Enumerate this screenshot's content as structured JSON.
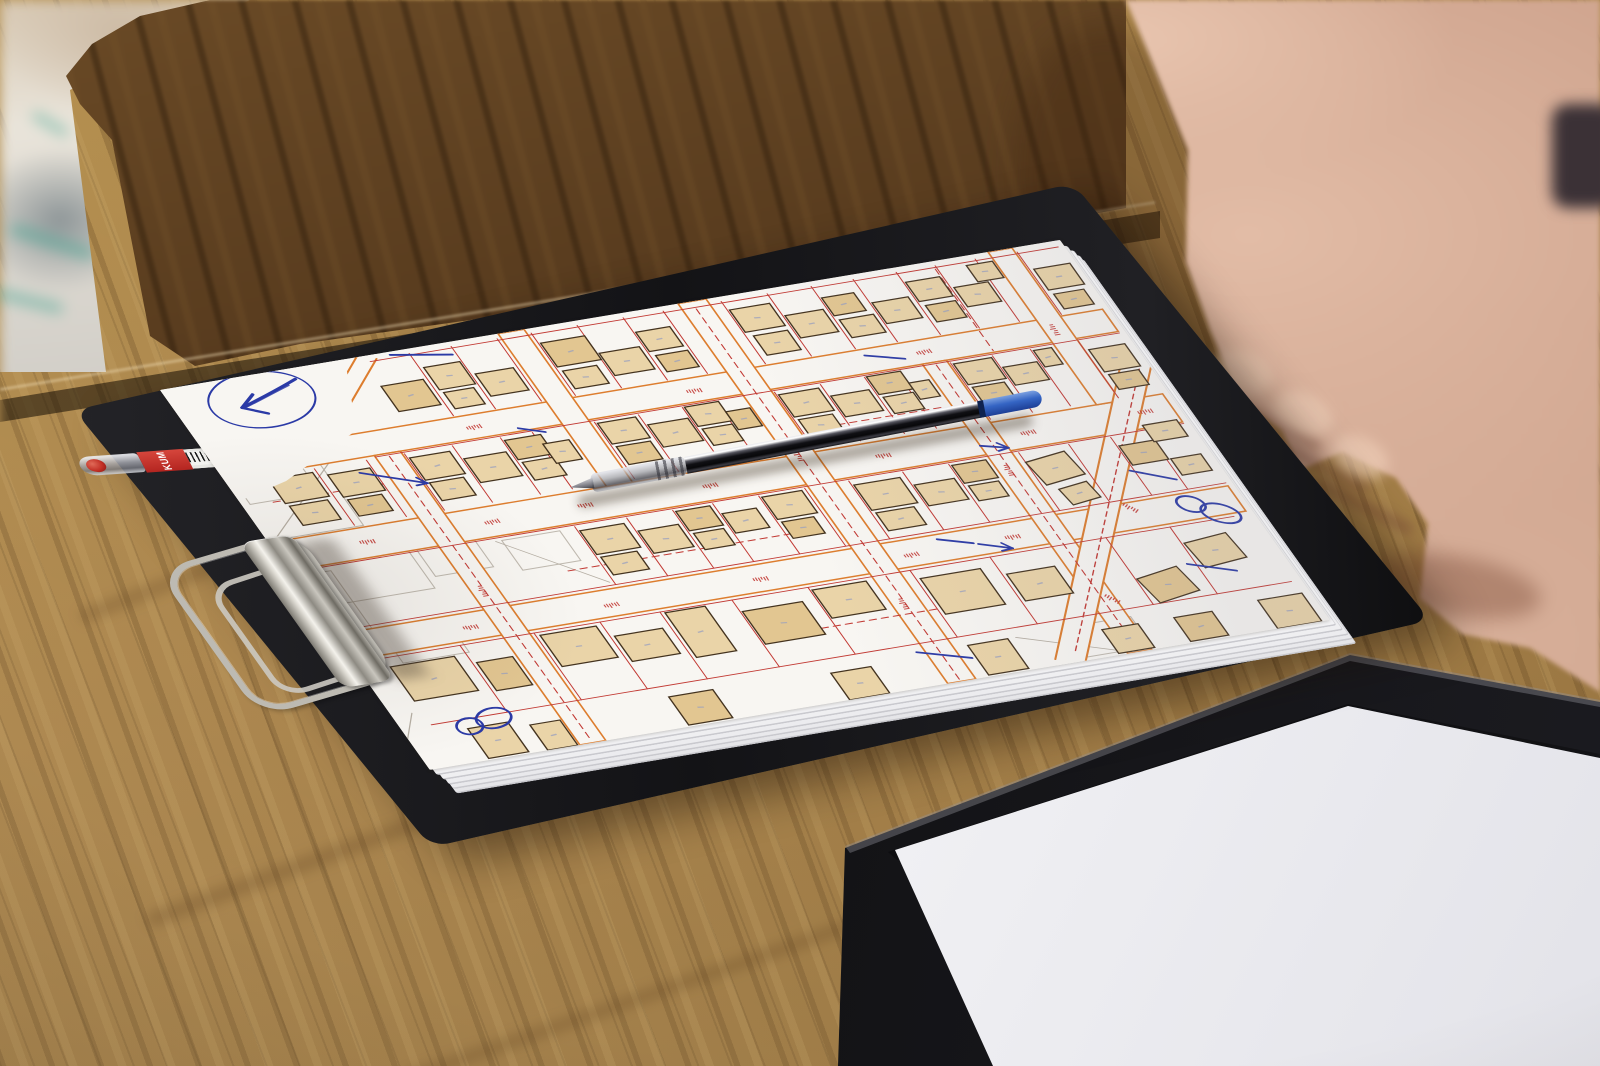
{
  "scene": {
    "description": "Photograph of a black clipboard on a light oak table holding a stack of printed cadastral city-map sheets annotated in blue pen; a transparent ballpoint pen with a blue cap lies across the map; a capped red pen is tucked under the clipboard; a metal clip holds the sheets; a person's hand rests on the table at top right; a second black folder with a blank white sheet sits at bottom right; a darker wooden table and blurred fabric appear in the background",
    "objects_present": [
      "oak table",
      "dark background table",
      "blurred fabric",
      "clipboard",
      "paper stack",
      "cadastral map",
      "metal clip",
      "red pen",
      "ballpoint pen",
      "hand",
      "black folder",
      "blank paper"
    ]
  },
  "colors": {
    "oak_table": "#ab854d",
    "dark_table": "#5a3d1f",
    "clipboard": "#17171a",
    "paper": "#f8f6f2",
    "building_fill": "#ead4a8",
    "building_stroke": "#44331f",
    "street_orange": "#dd7d2e",
    "parcel_red": "#c23a34",
    "pencil_gray": "#b5aea3",
    "ink_blue": "#2b3aa6",
    "pen_cap_blue": "#3565c4",
    "red_pen_body": "#3c1214",
    "skin": "#cfa48e"
  },
  "objects": {
    "red_pen": {
      "brand": "KUM",
      "has_barcode": true,
      "cap": "clear with red tip visible"
    },
    "ballpoint_pen": {
      "barrel": "translucent dark",
      "end_cap": "blue"
    },
    "clip": {
      "type": "flat metal clipboard clip with wire lever"
    },
    "annotations": {
      "style": "blue ballpoint handwriting: circled arrow, figure-eight loops, short strokes and small arrows"
    }
  },
  "map": {
    "buildings": [
      [
        200,
        40,
        42,
        34
      ],
      [
        250,
        26,
        36,
        30
      ],
      [
        252,
        60,
        30,
        22
      ],
      [
        292,
        44,
        38,
        30
      ],
      [
        370,
        20,
        44,
        32
      ],
      [
        372,
        58,
        34,
        24
      ],
      [
        416,
        44,
        40,
        30
      ],
      [
        462,
        26,
        34,
        26
      ],
      [
        465,
        58,
        32,
        22
      ],
      [
        560,
        18,
        40,
        30
      ],
      [
        565,
        54,
        34,
        26
      ],
      [
        606,
        36,
        38,
        30
      ],
      [
        650,
        22,
        32,
        24
      ],
      [
        652,
        52,
        34,
        24
      ],
      [
        692,
        38,
        36,
        28
      ],
      [
        735,
        20,
        34,
        26
      ],
      [
        738,
        52,
        30,
        22
      ],
      [
        775,
        36,
        34,
        26
      ],
      [
        800,
        12,
        26,
        22
      ],
      [
        858,
        30,
        36,
        28
      ],
      [
        860,
        64,
        30,
        20
      ],
      [
        40,
        130,
        44,
        32
      ],
      [
        42,
        166,
        38,
        26
      ],
      [
        96,
        136,
        42,
        30
      ],
      [
        98,
        170,
        34,
        22
      ],
      [
        180,
        132,
        40,
        30
      ],
      [
        182,
        166,
        34,
        24
      ],
      [
        228,
        144,
        42,
        32
      ],
      [
        276,
        130,
        36,
        26
      ],
      [
        278,
        160,
        32,
        24
      ],
      [
        308,
        142,
        26,
        26
      ],
      [
        370,
        128,
        38,
        28
      ],
      [
        372,
        160,
        34,
        24
      ],
      [
        414,
        140,
        40,
        30
      ],
      [
        458,
        126,
        34,
        26
      ],
      [
        460,
        156,
        30,
        22
      ],
      [
        492,
        140,
        24,
        24
      ],
      [
        550,
        130,
        40,
        30
      ],
      [
        552,
        164,
        34,
        22
      ],
      [
        596,
        142,
        38,
        28
      ],
      [
        640,
        126,
        34,
        24
      ],
      [
        642,
        154,
        30,
        22
      ],
      [
        674,
        142,
        20,
        22
      ],
      [
        726,
        128,
        38,
        28
      ],
      [
        728,
        160,
        32,
        22
      ],
      [
        768,
        142,
        34,
        24
      ],
      [
        806,
        128,
        18,
        22
      ],
      [
        856,
        138,
        36,
        30
      ],
      [
        858,
        172,
        30,
        20
      ],
      [
        286,
        254,
        44,
        32
      ],
      [
        288,
        290,
        36,
        24
      ],
      [
        338,
        266,
        40,
        30
      ],
      [
        384,
        250,
        34,
        26
      ],
      [
        386,
        280,
        30,
        22
      ],
      [
        424,
        262,
        34,
        26
      ],
      [
        470,
        250,
        40,
        30
      ],
      [
        472,
        284,
        32,
        22
      ],
      [
        560,
        254,
        46,
        34
      ],
      [
        562,
        292,
        38,
        24
      ],
      [
        614,
        266,
        40,
        28
      ],
      [
        660,
        250,
        34,
        24
      ],
      [
        662,
        278,
        30,
        20
      ],
      [
        730,
        258,
        42,
        32,
        -8
      ],
      [
        742,
        298,
        30,
        22,
        -8
      ],
      [
        822,
        260,
        36,
        26
      ],
      [
        856,
        240,
        34,
        22
      ],
      [
        860,
        286,
        30,
        22
      ],
      [
        30,
        380,
        64,
        46
      ],
      [
        110,
        392,
        36,
        38
      ],
      [
        184,
        372,
        56,
        42
      ],
      [
        250,
        388,
        48,
        34
      ],
      [
        310,
        370,
        40,
        60
      ],
      [
        380,
        384,
        60,
        44
      ],
      [
        456,
        372,
        54,
        38
      ],
      [
        560,
        380,
        60,
        48
      ],
      [
        640,
        392,
        48,
        36
      ],
      [
        756,
        420,
        44,
        34,
        -10
      ],
      [
        820,
        388,
        44,
        34,
        -6
      ],
      [
        60,
        470,
        40,
        40
      ],
      [
        118,
        478,
        30,
        34
      ],
      [
        260,
        472,
        44,
        38
      ],
      [
        420,
        476,
        40,
        36
      ],
      [
        560,
        470,
        40,
        40
      ],
      [
        690,
        478,
        36,
        32
      ],
      [
        762,
        478,
        38,
        32
      ],
      [
        848,
        474,
        44,
        38
      ]
    ],
    "streets_h": [
      {
        "y": 92,
        "h": 30
      },
      {
        "y": 206,
        "h": 38
      },
      {
        "y": 330,
        "h": 34
      }
    ],
    "streets_v": [
      {
        "x": 150,
        "w": 26,
        "y0": 122,
        "y1": 512
      },
      {
        "x": 338,
        "w": 26,
        "y0": 0,
        "y1": 206
      },
      {
        "x": 518,
        "w": 28,
        "y0": 0,
        "y1": 512
      },
      {
        "x": 698,
        "w": 24,
        "y0": 122,
        "y1": 512
      },
      {
        "x": 828,
        "w": 24,
        "y0": 0,
        "y1": 206
      }
    ],
    "streets_diag": [
      {
        "x1": 640,
        "y1": 512,
        "x2": 900,
        "y2": 150,
        "w": 26
      },
      {
        "x1": 208,
        "y1": 0,
        "x2": 140,
        "y2": 64,
        "w": 16
      }
    ],
    "red_v": [
      {
        "y1": 6,
        "y2": 90,
        "xs": [
          246,
          288,
          334,
          368,
          414,
          460,
          500,
          558,
          604,
          648,
          690,
          733,
          772,
          812,
          854
        ]
      },
      {
        "y1": 126,
        "y2": 202,
        "xs": [
          88,
          140,
          178,
          226,
          274,
          306,
          368,
          412,
          456,
          490,
          548,
          594,
          638,
          670,
          724,
          766,
          804,
          852
        ]
      },
      {
        "y1": 248,
        "y2": 326,
        "xs": [
          284,
          336,
          382,
          422,
          468,
          514,
          558,
          612,
          658,
          728,
          778,
          820,
          856
        ]
      },
      {
        "y1": 368,
        "y2": 458,
        "xs": [
          106,
          180,
          246,
          306,
          378,
          454,
          556,
          636,
          752,
          816
        ]
      }
    ],
    "red_h": [
      [
        6,
        246,
        894,
        246
      ],
      [
        6,
        326,
        894,
        326
      ],
      [
        20,
        368,
        880,
        368
      ],
      [
        30,
        458,
        890,
        458
      ],
      [
        150,
        124,
        894,
        124
      ],
      [
        206,
        8,
        894,
        8
      ]
    ],
    "dashed": [
      [
        30,
        158,
        140,
        158
      ],
      [
        560,
        178,
        690,
        178
      ],
      [
        250,
        300,
        500,
        300
      ],
      [
        380,
        420,
        620,
        420
      ],
      [
        163,
        126,
        163,
        510
      ],
      [
        531,
        10,
        531,
        510
      ],
      [
        710,
        126,
        710,
        510
      ],
      [
        770,
        10,
        770,
        120
      ],
      [
        653,
        498,
        890,
        170
      ]
    ],
    "gray_rects": [
      [
        -14,
        120,
        110,
        84
      ],
      [
        24,
        228,
        96,
        66
      ],
      [
        -28,
        252,
        66,
        110
      ],
      [
        128,
        240,
        58,
        40
      ],
      [
        44,
        330,
        66,
        48
      ],
      [
        8,
        96,
        70,
        60
      ],
      [
        210,
        250,
        58,
        40
      ],
      [
        660,
        468,
        64,
        40
      ]
    ],
    "gray_lines": [
      [
        0,
        210,
        140,
        92
      ],
      [
        40,
        100,
        120,
        40
      ],
      [
        204,
        250,
        280,
        322
      ],
      [
        608,
        470,
        700,
        510
      ],
      [
        20,
        440,
        0,
        470
      ]
    ],
    "red_ticks": [
      [
        82,
        222,
        4
      ],
      [
        206,
        224,
        -3
      ],
      [
        300,
        222,
        2
      ],
      [
        424,
        224,
        -2
      ],
      [
        598,
        222,
        3
      ],
      [
        742,
        224,
        -2
      ],
      [
        860,
        222,
        0
      ],
      [
        120,
        346,
        2
      ],
      [
        260,
        348,
        -2
      ],
      [
        410,
        346,
        3
      ],
      [
        560,
        348,
        -3
      ],
      [
        662,
        346,
        2
      ],
      [
        250,
        106,
        -2
      ],
      [
        470,
        106,
        2
      ],
      [
        700,
        106,
        -3
      ],
      [
        790,
        330,
        52
      ],
      [
        716,
        436,
        52
      ],
      [
        163,
        300,
        90
      ],
      [
        531,
        200,
        90
      ],
      [
        531,
        400,
        90
      ],
      [
        710,
        260,
        90
      ],
      [
        840,
        100,
        90
      ]
    ],
    "blank_corner": "0,0 185,0 150,88 55,135 0,150",
    "blue": {
      "circle": {
        "cx": 85,
        "cy": 32,
        "rx": 52,
        "ry": 35,
        "rot": -6
      },
      "arrow_shaft": "M128,14 C108,22 86,30 62,38",
      "arrow_shaft2": "M118,20 C100,26 84,32 66,38",
      "arrow_head": "M62,38 L80,24 M62,38 L82,50",
      "strokes": [
        [
          228,
          4,
          284,
          16
        ],
        [
          126,
          140,
          180,
          166
        ],
        [
          600,
          336,
          630,
          348
        ],
        [
          634,
          350,
          662,
          362
        ],
        [
          652,
          100,
          686,
          112
        ],
        [
          816,
          292,
          852,
          312
        ],
        [
          808,
          416,
          848,
          434
        ],
        [
          296,
          118,
          318,
          128
        ],
        [
          510,
          468,
          556,
          486
        ],
        [
          698,
          232,
          722,
          240
        ]
      ],
      "arrow_on": [
        1,
        3,
        9
      ],
      "loops": [
        {
          "cx": 76,
          "cy": 464,
          "rot": -15
        },
        {
          "cx": 860,
          "cy": 352,
          "rot": 35
        }
      ]
    }
  }
}
